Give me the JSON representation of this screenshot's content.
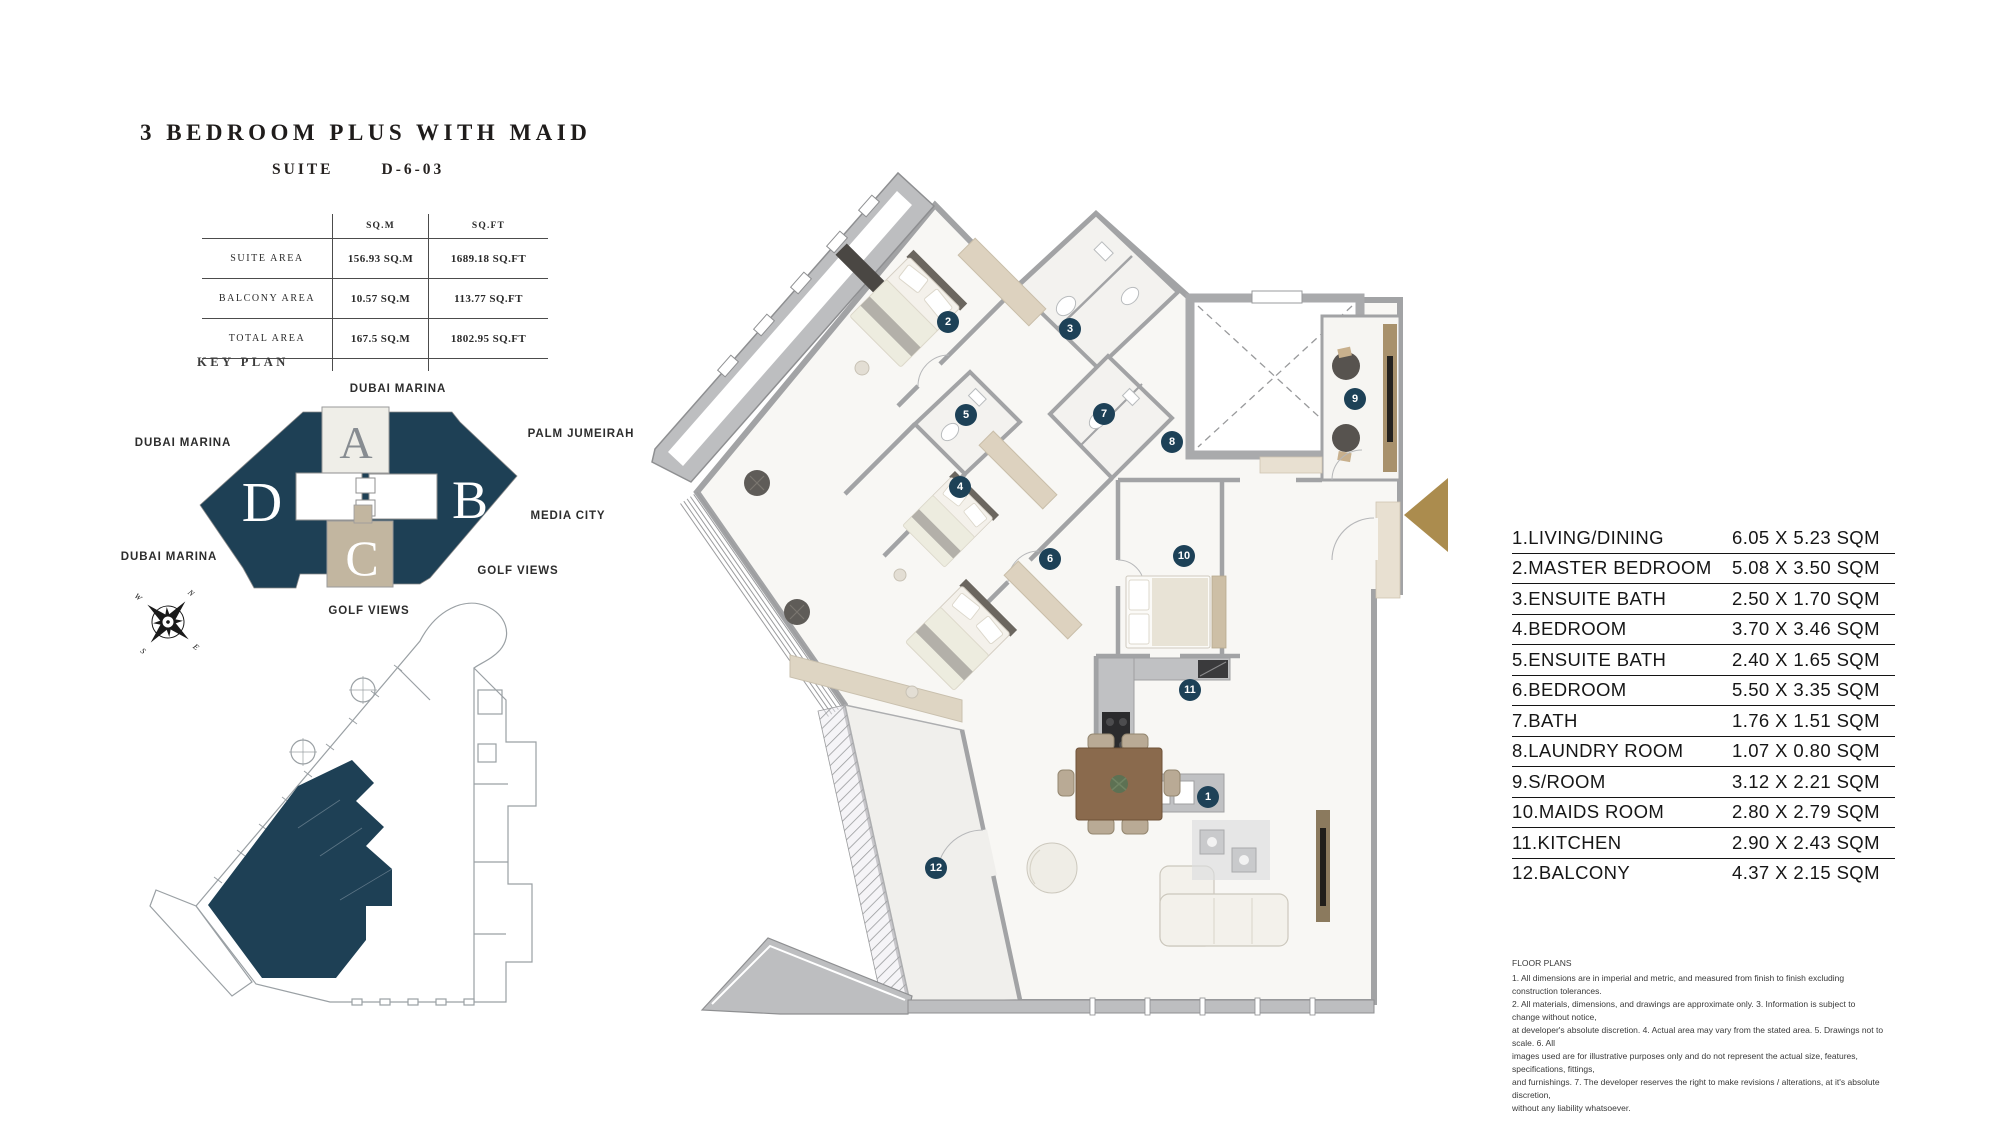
{
  "header": {
    "title": "3 BEDROOM PLUS WITH MAID",
    "suite_label": "SUITE",
    "suite_number": "D-6-03"
  },
  "area_table": {
    "headers": {
      "sqm": "SQ.M",
      "sqft": "SQ.FT"
    },
    "rows": [
      {
        "label": "SUITE AREA",
        "sqm": "156.93 SQ.M",
        "sqft": "1689.18 SQ.FT"
      },
      {
        "label": "BALCONY AREA",
        "sqm": "10.57 SQ.M",
        "sqft": "113.77 SQ.FT"
      },
      {
        "label": "TOTAL AREA",
        "sqm": "167.5 SQ.M",
        "sqft": "1802.95 SQ.FT"
      }
    ]
  },
  "key_plan": {
    "heading": "KEY PLAN",
    "sections": {
      "a": "A",
      "b": "B",
      "c": "C",
      "d": "D"
    },
    "labels": {
      "top": "DUBAI MARINA",
      "left": "DUBAI MARINA",
      "right_top": "PALM JUMEIRAH",
      "right_mid": "MEDIA CITY",
      "right_bottom": "GOLF VIEWS",
      "bottom_left": "DUBAI MARINA",
      "bottom_center": "GOLF VIEWS"
    }
  },
  "compass": {
    "north": "N",
    "east": "E",
    "south": "S",
    "west": "W"
  },
  "room_list": [
    {
      "name": "1.LIVING/DINING",
      "dims": "6.05 X 5.23 SQM"
    },
    {
      "name": "2.MASTER BEDROOM",
      "dims": "5.08 X 3.50 SQM"
    },
    {
      "name": "3.ENSUITE BATH",
      "dims": "2.50 X 1.70 SQM"
    },
    {
      "name": "4.BEDROOM",
      "dims": "3.70 X 3.46 SQM"
    },
    {
      "name": "5.ENSUITE BATH",
      "dims": "2.40 X 1.65 SQM"
    },
    {
      "name": "6.BEDROOM",
      "dims": "5.50 X 3.35 SQM"
    },
    {
      "name": "7.BATH",
      "dims": "1.76 X 1.51 SQM"
    },
    {
      "name": "8.LAUNDRY ROOM",
      "dims": "1.07 X 0.80 SQM"
    },
    {
      "name": "9.S/ROOM",
      "dims": "3.12 X 2.21 SQM"
    },
    {
      "name": "10.MAIDS ROOM",
      "dims": "2.80 X 2.79 SQM"
    },
    {
      "name": "11.KITCHEN",
      "dims": "2.90 X 2.43 SQM"
    },
    {
      "name": "12.BALCONY",
      "dims": "4.37 X 2.15 SQM"
    }
  ],
  "plan_markers": [
    {
      "n": "1",
      "x": 1208,
      "y": 797
    },
    {
      "n": "2",
      "x": 948,
      "y": 322
    },
    {
      "n": "3",
      "x": 1070,
      "y": 329
    },
    {
      "n": "4",
      "x": 960,
      "y": 487
    },
    {
      "n": "5",
      "x": 966,
      "y": 415
    },
    {
      "n": "6",
      "x": 1050,
      "y": 559
    },
    {
      "n": "7",
      "x": 1104,
      "y": 414
    },
    {
      "n": "8",
      "x": 1172,
      "y": 442
    },
    {
      "n": "9",
      "x": 1355,
      "y": 399
    },
    {
      "n": "10",
      "x": 1184,
      "y": 556
    },
    {
      "n": "11",
      "x": 1190,
      "y": 690
    },
    {
      "n": "12",
      "x": 936,
      "y": 868
    }
  ],
  "disclaimer": {
    "heading": "FLOOR PLANS",
    "lines": [
      "1. All dimensions are in imperial and metric, and measured from finish to finish excluding construction tolerances.",
      "2. All materials, dimensions, and drawings are approximate only. 3. Information is subject to change without notice,",
      "at developer's absolute discretion. 4. Actual area may vary from the stated area. 5. Drawings not to scale. 6. All",
      "images used are for illustrative purposes only and do not represent the actual size, features, specifications, fittings,",
      "and furnishings. 7. The developer reserves the right to make revisions / alterations, at it's absolute discretion,",
      "without any liability whatsoever."
    ]
  },
  "colors": {
    "navy": "#1e4055",
    "gold": "#ab8c4e",
    "tan": "#c2b6a0",
    "cream": "#efeee8",
    "wall_gray": "#a2a3a5",
    "marker_navy": "#1d4157"
  }
}
